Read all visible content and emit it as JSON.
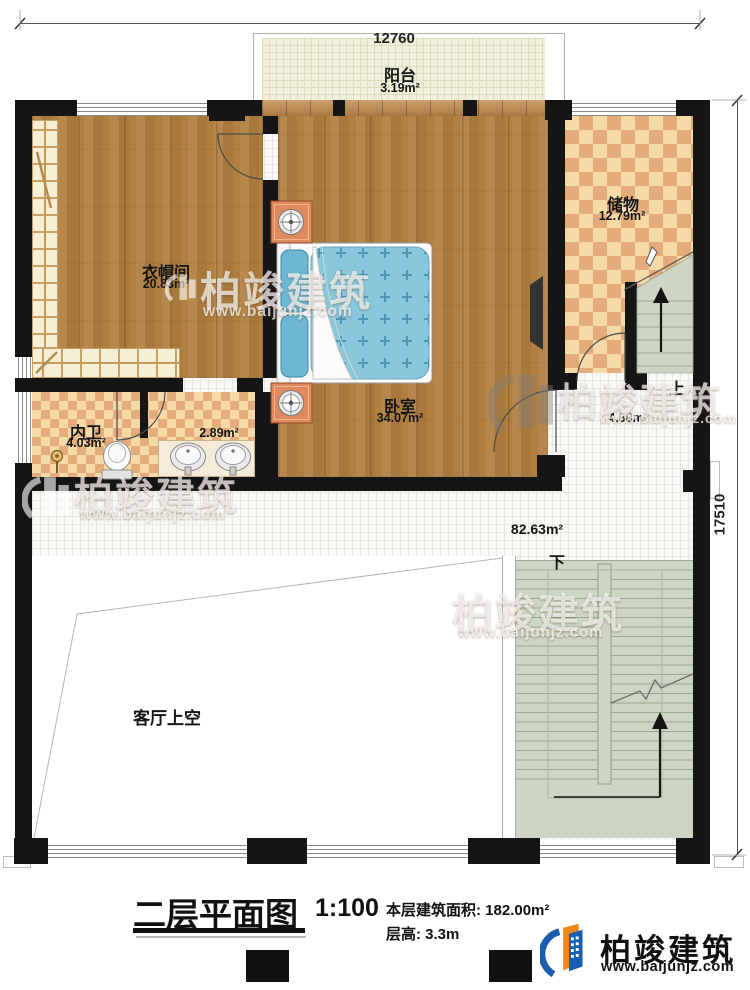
{
  "dimensions": {
    "width": "12760",
    "height": "17510"
  },
  "rooms": {
    "balcony": {
      "label": "阳台",
      "area": "3.19m²"
    },
    "cloakroom": {
      "label": "衣帽间",
      "area": "20.83m²"
    },
    "bedroom": {
      "label": "卧室",
      "area": "34.07m²"
    },
    "storage": {
      "label": "储物",
      "area": "12.79m²"
    },
    "bathroom": {
      "label": "内卫",
      "area": "4.03m²"
    },
    "vanity": {
      "area": "2.89m²"
    },
    "stair_landing": {
      "area": "4.58m²"
    },
    "hall": {
      "area": "82.63m²"
    },
    "living_void": {
      "label": "客厅上空"
    }
  },
  "stairs": {
    "up": "上",
    "down": "下"
  },
  "title_block": {
    "title": "二层平面图",
    "scale": "1:100",
    "floor_area_label": "本层建筑面积:",
    "floor_area_value": "182.00m²",
    "floor_height_label": "层高:",
    "floor_height_value": "3.3m"
  },
  "brand": {
    "name": "柏竣建筑",
    "website": "www.baijunjz.com"
  },
  "colors": {
    "wall": "#151515",
    "wood_floor": "#b17f40",
    "checker_light": "#f5d9a7",
    "checker_dark": "#e4ac7a",
    "stair_green": "#cdd6c4",
    "bed_blue": "#85c6dc",
    "brand_blue": "#1d5dae",
    "brand_orange": "#f08519"
  }
}
